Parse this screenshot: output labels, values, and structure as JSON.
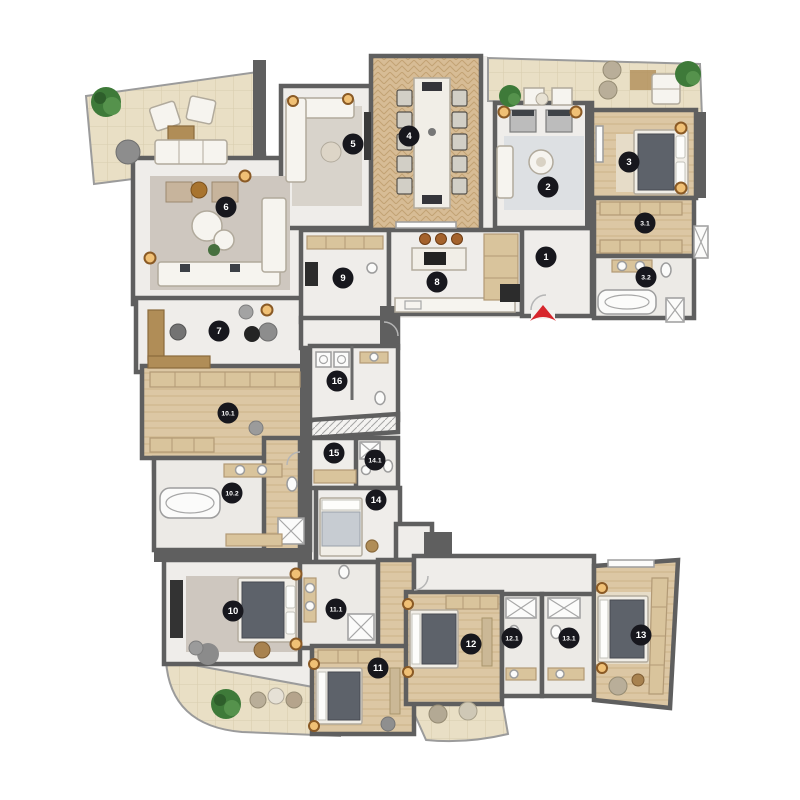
{
  "plan": {
    "markers": [
      {
        "label": "1",
        "x": 546,
        "y": 257
      },
      {
        "label": "2",
        "x": 548,
        "y": 187
      },
      {
        "label": "3",
        "x": 629,
        "y": 162
      },
      {
        "label": "3.1",
        "x": 645,
        "y": 223
      },
      {
        "label": "3.2",
        "x": 646,
        "y": 277
      },
      {
        "label": "4",
        "x": 409,
        "y": 136
      },
      {
        "label": "5",
        "x": 353,
        "y": 144
      },
      {
        "label": "6",
        "x": 226,
        "y": 207
      },
      {
        "label": "7",
        "x": 219,
        "y": 331
      },
      {
        "label": "8",
        "x": 437,
        "y": 282
      },
      {
        "label": "9",
        "x": 343,
        "y": 278
      },
      {
        "label": "10",
        "x": 233,
        "y": 611
      },
      {
        "label": "10.1",
        "x": 228,
        "y": 413
      },
      {
        "label": "10.2",
        "x": 232,
        "y": 493
      },
      {
        "label": "11",
        "x": 378,
        "y": 668
      },
      {
        "label": "11.1",
        "x": 336,
        "y": 609
      },
      {
        "label": "12",
        "x": 471,
        "y": 644
      },
      {
        "label": "12.1",
        "x": 512,
        "y": 638
      },
      {
        "label": "13",
        "x": 641,
        "y": 635
      },
      {
        "label": "13.1",
        "x": 569,
        "y": 638
      },
      {
        "label": "14",
        "x": 376,
        "y": 500
      },
      {
        "label": "14.1",
        "x": 375,
        "y": 460
      },
      {
        "label": "15",
        "x": 334,
        "y": 453
      },
      {
        "label": "16",
        "x": 337,
        "y": 381
      }
    ],
    "entrance": {
      "x": 543,
      "y": 314,
      "direction": "up"
    },
    "palette": {
      "wall": "#5f5f5f",
      "floor": "#efedea",
      "wood_floor": "#dcc7a4",
      "terrace": "#e9dfc5",
      "marker": "#17171d",
      "marker_text": "#ffffff",
      "entrance_arrow": "#d7262c",
      "tree": "#3e7a39",
      "accent_wood": "#b08d57"
    }
  }
}
